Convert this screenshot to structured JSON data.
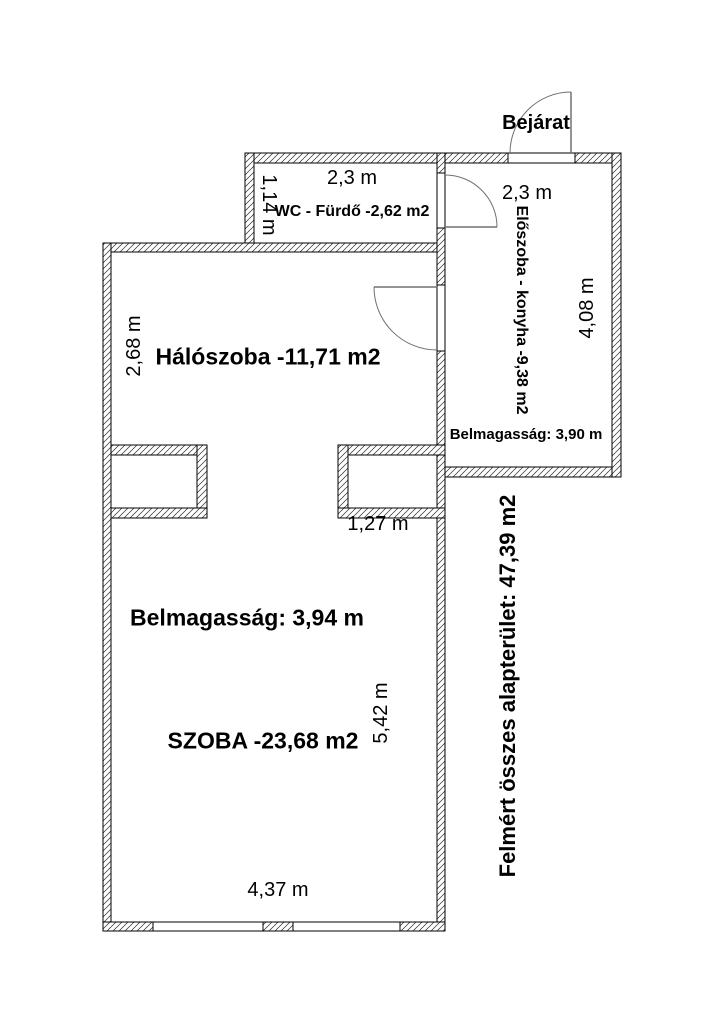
{
  "entrance": {
    "label": "Bejárat"
  },
  "rooms": {
    "wc_bathroom": {
      "label": "WC - Fürdő -2,62 m2",
      "width_dim": "2,3 m",
      "depth_dim": "1,14 m"
    },
    "hallway_kitchen": {
      "label": "Előszoba - konyha -9,38 m2",
      "width_dim": "2,3 m",
      "length_dim": "4,08 m",
      "ceiling_height": "Belmagasság: 3,90 m"
    },
    "bedroom": {
      "label": "Hálószoba -11,71 m2",
      "depth_dim": "2,68 m"
    },
    "living_room": {
      "label": "SZOBA -23,68 m2",
      "ceiling_height": "Belmagasság: 3,94 m",
      "length_dim": "5,42 m",
      "width_dim": "4,37 m"
    },
    "passage": {
      "width_dim": "1,27 m"
    }
  },
  "summary": {
    "total_area_label": "Felmért összes alapterület: 47,39 m2"
  },
  "colors": {
    "background": "#ffffff",
    "wall_line": "#000000",
    "text": "#000000",
    "door_line": "#707070"
  }
}
